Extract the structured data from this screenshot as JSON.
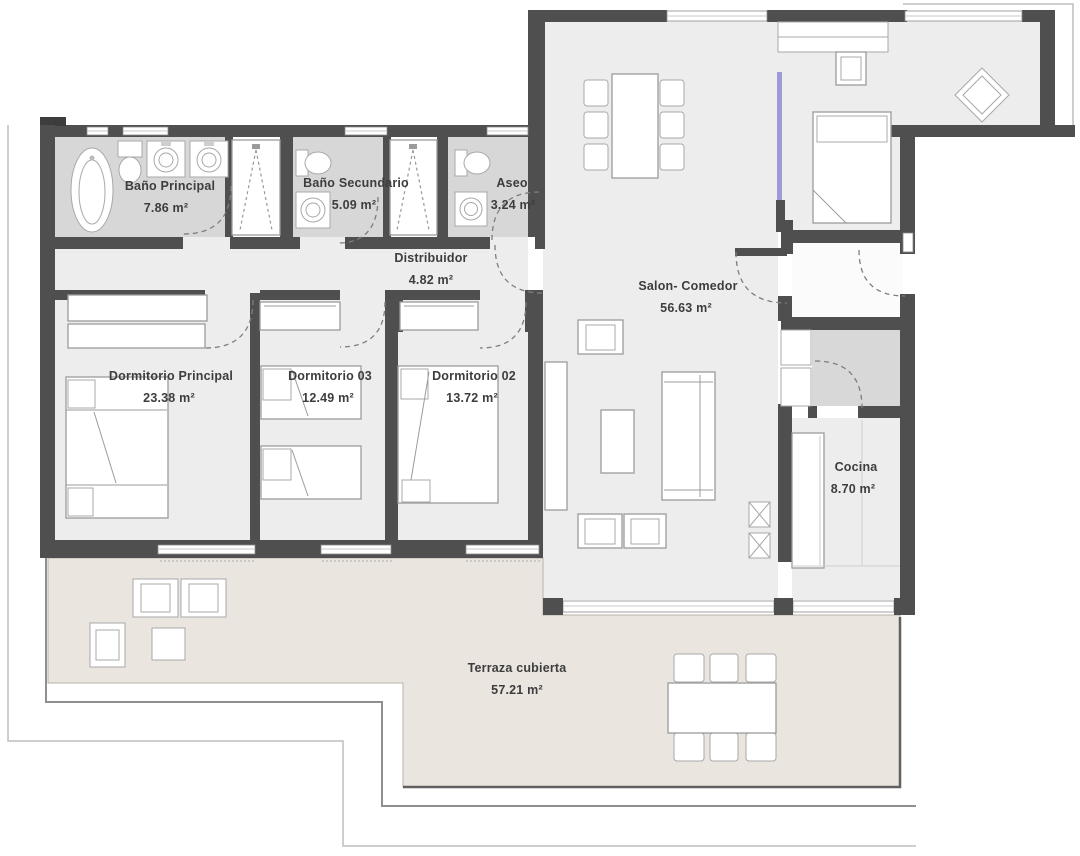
{
  "plan": {
    "type": "apartment-floor-plan",
    "unit_label_style": "room name + area",
    "rooms": [
      {
        "name": "Baño Principal",
        "area": "7.86 m²"
      },
      {
        "name": "Baño Secundario",
        "area": "5.09 m²"
      },
      {
        "name": "Aseo",
        "area": "3.24 m²"
      },
      {
        "name": "Distribuidor",
        "area": "4.82 m²"
      },
      {
        "name": "Salon- Comedor",
        "area": "56.63 m²"
      },
      {
        "name": "Dormitorio Principal",
        "area": "23.38 m²"
      },
      {
        "name": "Dormitorio 03",
        "area": "12.49 m²"
      },
      {
        "name": "Dormitorio 02",
        "area": "13.72 m²"
      },
      {
        "name": "Cocina",
        "area": "8.70 m²"
      },
      {
        "name": "Terraza cubierta",
        "area": "57.21 m²"
      }
    ],
    "colors": {
      "wall": "#4f4f4f",
      "room_floor": "#ededed",
      "bathroom_floor": "#d7d7d7",
      "storage_floor": "#d8d8d8",
      "terrace_floor": "#ebe5e0",
      "glass_accent": "#9b9bd7",
      "text": "#3d3d3d"
    }
  }
}
